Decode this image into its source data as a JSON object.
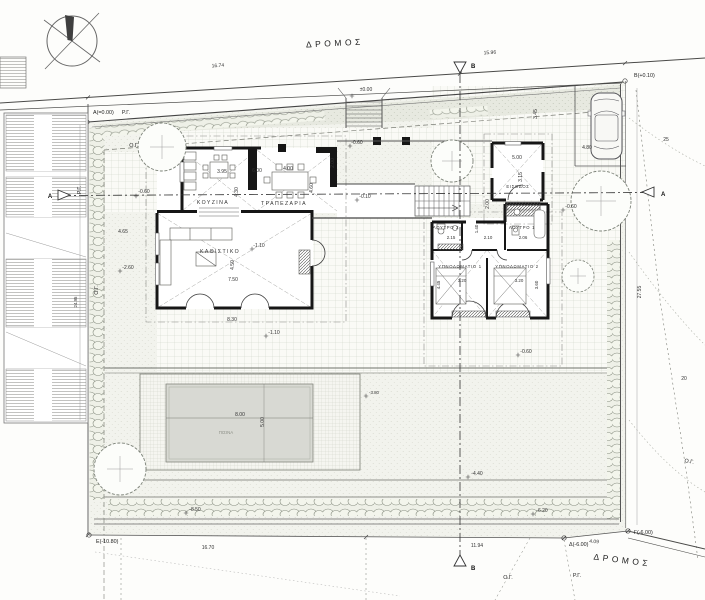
{
  "site": {
    "road": "ΔΡΟΜΟΣ",
    "corner_a": "Α(=0.00)",
    "corner_b": "Β(+0.10)",
    "corner_c": "Γ(-6.00)",
    "corner_d": "Δ(-6.00)",
    "corner_e": "Ε(-10.80)",
    "rg": "Ρ.Γ.",
    "og": "Ο.Γ.",
    "dim_top_w": "16.74",
    "dim_top_e": "15.96",
    "dim_bottom_w": "16.70",
    "dim_bottom_m": "11.94",
    "dim_bottom_e": "4.09",
    "dim_side_e": "27.55",
    "dim_side_w": "24.95",
    "contour_hi": "25",
    "contour_lo": "20",
    "sec_a": "Α",
    "sec_b": "Β"
  },
  "levels": {
    "zero": "±0.00",
    "m010": "-0.10",
    "m060": "-0.60",
    "m110": "-1.10",
    "m260": "-2.60",
    "m380": "-3.80",
    "m440": "-4.40",
    "m620": "-6.20",
    "m850": "-8.50"
  },
  "rooms": {
    "kitchen": {
      "label": "ΚΟΥΖΙΝΑ",
      "w": "3.95",
      "d": "4.30"
    },
    "dining": {
      "label": "ΤΡΑΠΕΖΑΡΙΑ",
      "w": "4.00",
      "d": "4.60"
    },
    "living": {
      "label": "ΚΑΘΙΣΤΙΚΟ",
      "w": "7.50",
      "w2": "8.30",
      "d": "4.50"
    },
    "entry": {
      "label": "ΕΙΣΟΔΟΣ",
      "w": "5.00",
      "d": "3.15"
    },
    "bath1": {
      "label": "ΛΟΥΤΡΟ 1",
      "w": "2.06"
    },
    "bath2": {
      "label": "ΛΟΥΤΡΟ 2",
      "w": "2.15"
    },
    "hall": {
      "w": "2.10",
      "d": "1.40"
    },
    "bed1": {
      "label": "ΥΠΝΟΔΩΜΑΤΙΟ 1",
      "w": "3.20",
      "d": "4.45"
    },
    "bed2": {
      "label": "ΥΠΝΟΔΩΜΑΤΙΟ 2",
      "w": "3.20",
      "d": "3.60"
    },
    "pool": {
      "label": "ΠΙΣΙΝΑ",
      "w": "8.00",
      "d": "5.00"
    },
    "parking": {
      "w": "4.80"
    }
  },
  "misc": {
    "d600": "6.00",
    "d200": "2.00",
    "d345": "3.45",
    "d465": "4.65"
  },
  "colors": {
    "wall": "#161616",
    "paper": "#fdfdfb",
    "pool_water": "#d8d9d3",
    "planting": "#e7e9e0"
  }
}
